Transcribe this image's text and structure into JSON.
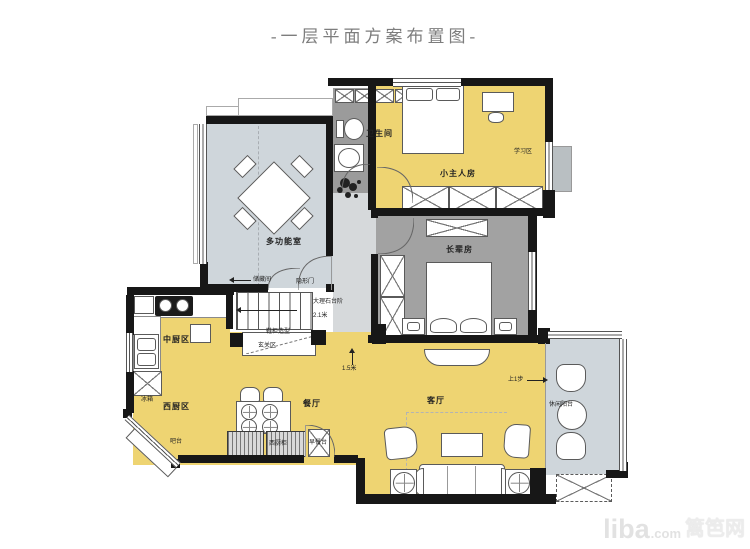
{
  "title": "-一层平面方案布置图-",
  "watermark": {
    "brand": "liba",
    "domain": ".com",
    "suffix": "篱笆网"
  },
  "palette": {
    "floor_yellow": "#eed472",
    "floor_dark_gray": "#a2a2a2",
    "floor_blue_gray": "#cfd6db",
    "floor_hall_gray": "#d6d9db",
    "wall_black": "#171717",
    "outline_gray": "#5a5a5a",
    "title_text": "#7d7d7d",
    "watermark_text": "#e2e2e2"
  },
  "rooms": {
    "multi": "多功能室",
    "bath": "卫生间",
    "kid": "小主人房",
    "study": "学习区",
    "elder": "长辈房",
    "dining": "餐厅",
    "living": "客厅",
    "kitchen_cn": "中厨区",
    "kitchen_w": "西厨区",
    "balcony": "休闲阳台"
  },
  "annotations": {
    "storage": "储藏间",
    "hidden_door": "隐形门",
    "marble": "大理石台阶",
    "height": "2.1米",
    "shoe": "鞋柜造型",
    "foyer": "玄关区",
    "width": "1.5米",
    "step_up": "上1步",
    "fridge": "冰箱",
    "bar": "吧台",
    "west_cab": "西厨柜",
    "breakfast": "早餐台"
  }
}
